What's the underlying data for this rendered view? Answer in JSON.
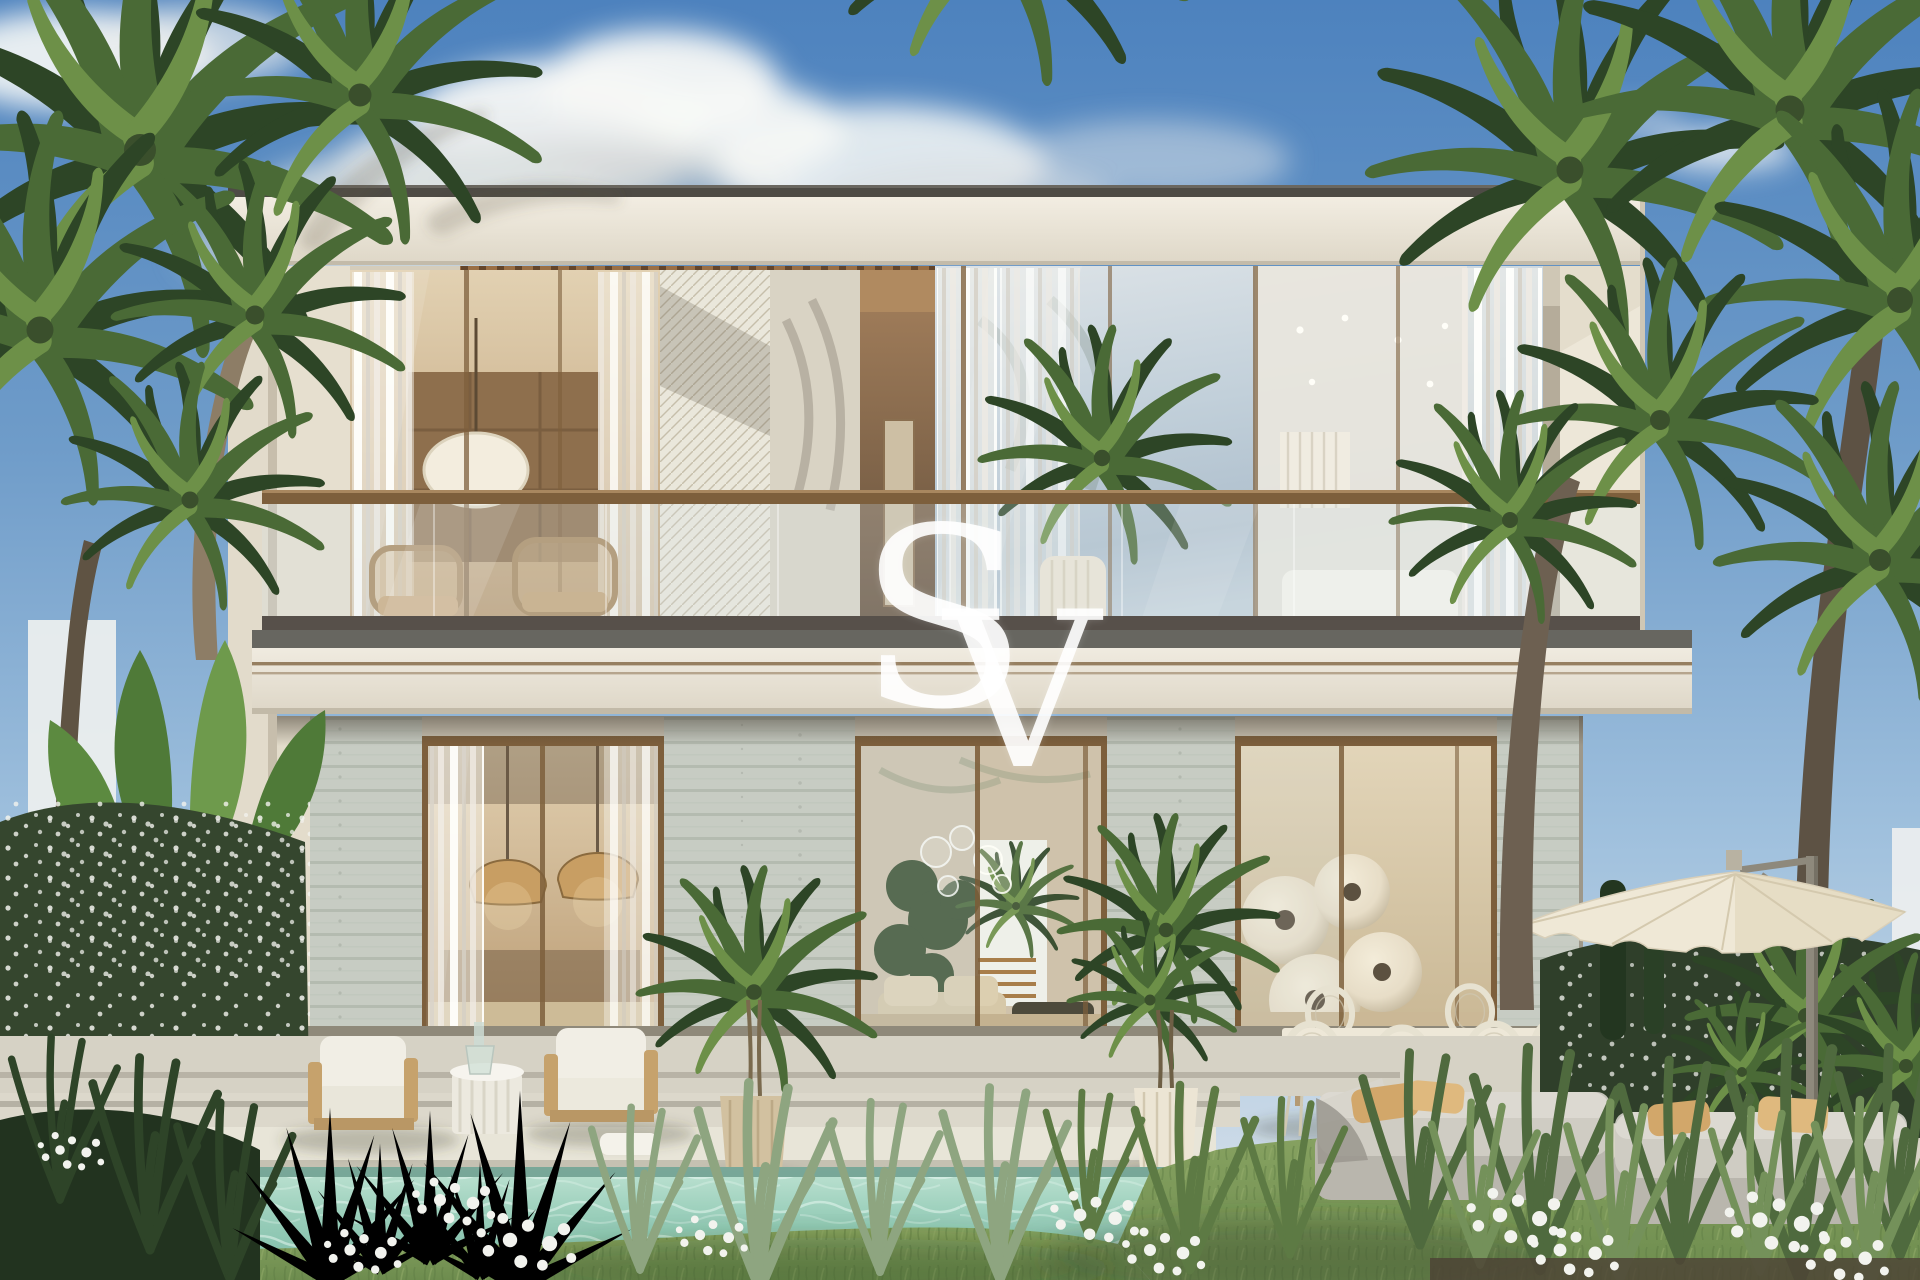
{
  "watermark": {
    "letter_s": "S",
    "letter_v": "V"
  },
  "palette": {
    "sky_top": "#4d82be",
    "sky_mid": "#6f9cc9",
    "sky_low": "#9fc0dd",
    "sky_horizon": "#cfdce8",
    "cloud_bright": "#f7f8f6",
    "cloud_shade": "#c9ccc9",
    "facade_cream": "#ebe6da",
    "facade_deep": "#ded7c7",
    "flank": "#e2dbcb",
    "roof_edge": "#4e4b45",
    "plaster": "#d9d3c4",
    "lattice": "#eae7db",
    "wood_slat": "#9a6f45",
    "wood_slat_dark": "#64452a",
    "bronze": "#7d5f3c",
    "stone": "#c7ccc3",
    "stone_line": "#a3aca0",
    "slab_edge": "#676660",
    "pinstripe": "#8d7352",
    "curtain_hi": "#f4f1e8",
    "glass_warm_a": "#e2d1b2",
    "glass_warm_b": "#bb9c74",
    "glass_sky_a": "#dde3e7",
    "glass_sky_b": "#c2d0da",
    "glass_sky_c": "#aebfcd",
    "white_room": "#efece4",
    "interior_beige": "#d8c9ae",
    "interior_floor": "#c8b694",
    "patio": "#d6d2c5",
    "patio_line": "#b0ab9e",
    "coping": "#e8e5d8",
    "water_a": "#bfe3d3",
    "water_b": "#9bcfbb",
    "water_c": "#83bfab",
    "water_line": "#68998a",
    "lawn": "#7f9b5e",
    "lawn_dark": "#5a7740",
    "lawn_light": "#95ae6b",
    "palm_dark": "#2d4526",
    "palm_mid": "#4a6a36",
    "palm_light": "#6d9048",
    "palm_pale": "#8fb068",
    "trunk": "#8d7d66",
    "trunk_dark": "#5f5343",
    "hedge": "#35462e",
    "flower_white": "#f2f3ee",
    "banana": "#4f7a38",
    "pot_terra": "#d2c1a0",
    "pot_white": "#ece5d4",
    "cushion_tan": "#d2a76a",
    "cushion_tan_hi": "#dfb97e",
    "daybed": "#cfccc3",
    "daybed_side": "#b9b6ad",
    "umbrella": "#efe8d6",
    "umbrella_shade": "#ded3b8",
    "pole": "#8e897c",
    "chair_white": "#f1eee5",
    "chair_wood": "#c6a26c",
    "wicker": "#e7e2d1",
    "wicker_line": "#cfc8b2",
    "neighbor_wall": "#eef0ef",
    "art_disc": "#e7ddc7",
    "art_hole": "#5c5140",
    "pendant_shade": "#c89e63",
    "soil": "#4c4134"
  }
}
